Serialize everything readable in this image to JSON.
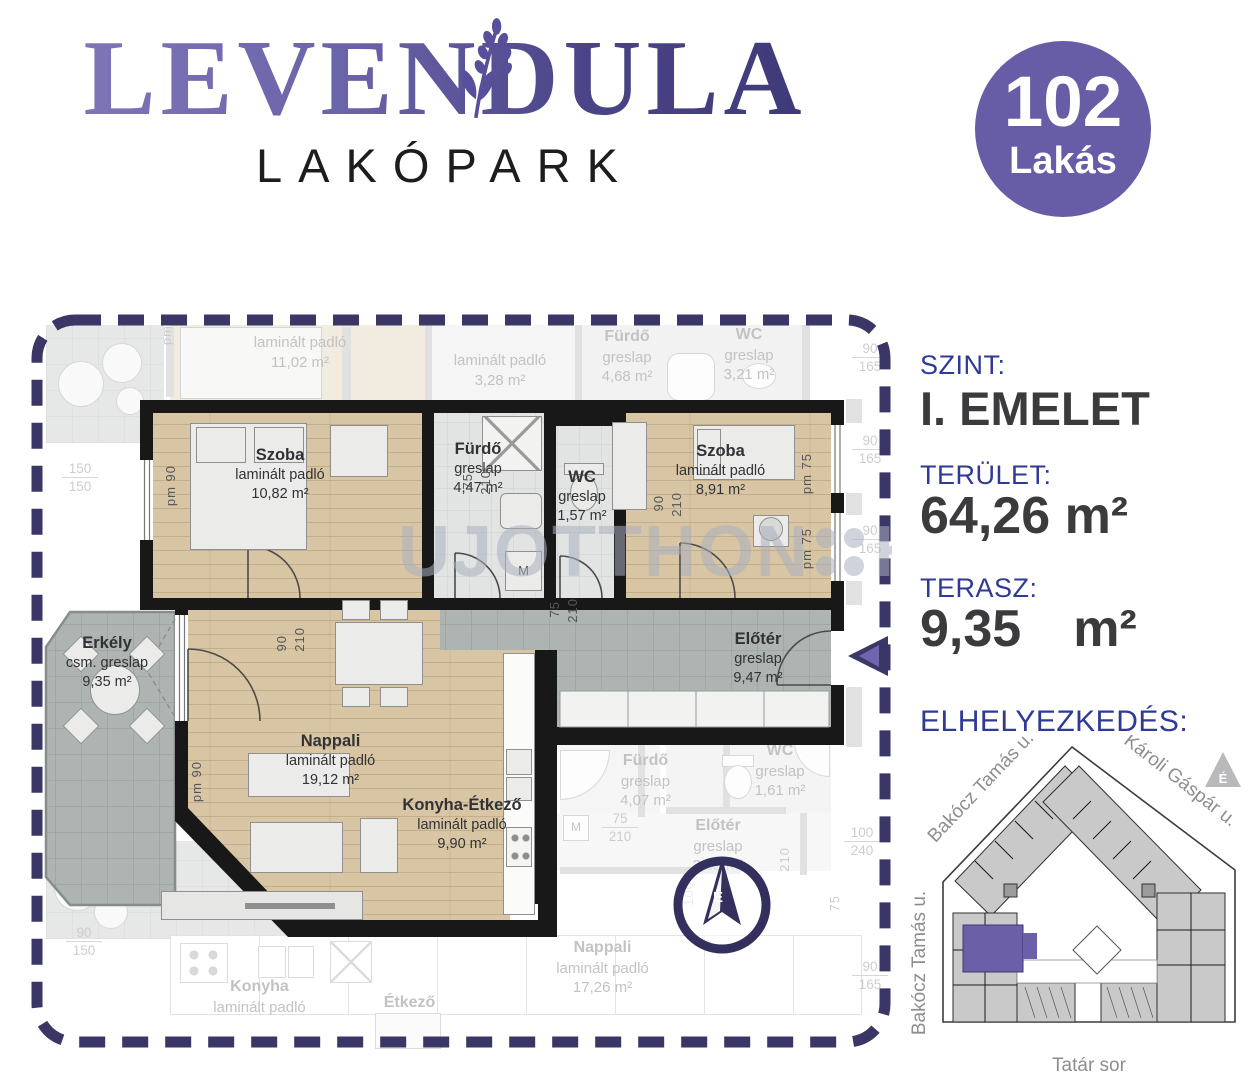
{
  "header": {
    "brand": "LEVENDULA",
    "brand_sub": "LAKÓPARK",
    "badge_number": "102",
    "badge_label": "Lakás"
  },
  "sidebar": {
    "floor_label": "SZINT:",
    "floor_value": "I. EMELET",
    "area_label": "TERÜLET:",
    "area_value": "64,26 m²",
    "terrace_label": "TERASZ:",
    "terrace_number": "9,35",
    "terrace_unit": "m²",
    "location_label": "ELHELYEZKEDÉS:",
    "map": {
      "street_top_left": "Bakócz Tamás u.",
      "street_top_right": "Károli Gáspár u.",
      "street_left": "Bakócz Tamás u.",
      "street_bottom": "Tatár sor",
      "compass": "É"
    }
  },
  "plan": {
    "watermark_left": "UJOTTHON",
    "watermark_right": "HU",
    "compass": "É",
    "rooms": [
      {
        "name": "Szoba",
        "floor": "laminált padló",
        "area": "10,82 m²"
      },
      {
        "name": "Fürdő",
        "floor": "greslap",
        "area": "4,47 m²"
      },
      {
        "name": "WC",
        "floor": "greslap",
        "area": "1,57 m²"
      },
      {
        "name": "Szoba",
        "floor": "laminált padló",
        "area": "8,91 m²"
      },
      {
        "name": "Előtér",
        "floor": "greslap",
        "area": "9,47 m²"
      },
      {
        "name": "Erkély",
        "floor": "csm. greslap",
        "area": "9,35 m²"
      },
      {
        "name": "Nappali",
        "floor": "laminált padló",
        "area": "19,12 m²"
      },
      {
        "name": "Konyha-Étkező",
        "floor": "laminált padló",
        "area": "9,90 m²"
      }
    ],
    "neighbors": [
      {
        "name": "",
        "floor": "laminált padló",
        "area": "11,02 m²"
      },
      {
        "name": "",
        "floor": "laminált padló",
        "area": "3,28 m²"
      },
      {
        "name": "Fürdő",
        "floor": "greslap",
        "area": "4,68 m²"
      },
      {
        "name": "WC",
        "floor": "greslap",
        "area": "3,21 m²"
      },
      {
        "name": "Fürdő",
        "floor": "greslap",
        "area": "4,07 m²"
      },
      {
        "name": "WC",
        "floor": "greslap",
        "area": "1,61 m²"
      },
      {
        "name": "Előtér",
        "floor": "greslap",
        "area": "3,32 m²"
      },
      {
        "name": "Nappali",
        "floor": "laminált padló",
        "area": "17,26 m²"
      },
      {
        "name": "Konyha",
        "floor": "laminált padló",
        "area": ""
      },
      {
        "name": "Étkező",
        "floor": "",
        "area": ""
      }
    ],
    "dims": {
      "d75": "75",
      "d90": "90",
      "d100": "100",
      "d150": "150",
      "d165": "165",
      "d180": "180",
      "d210": "210",
      "d240": "240",
      "pm90": "pm 90",
      "pm75": "pm 75",
      "pm": "pm"
    },
    "fixtures": {
      "washer": "M"
    }
  },
  "colors": {
    "brand_gradient_start": "#8078ba",
    "brand_gradient_end": "#3c3875",
    "badge_bg": "#675ca6",
    "dash_navy": "#3a3666",
    "sidebar_label_blue": "#2e3a96",
    "value_dark": "#3b3b3d",
    "wood": "#d8c5a4",
    "tile_gray": "#b6bdba",
    "entry_tile": "#adb4b1",
    "wall_black": "#181818",
    "site_unit_purple": "#6b60a8"
  }
}
